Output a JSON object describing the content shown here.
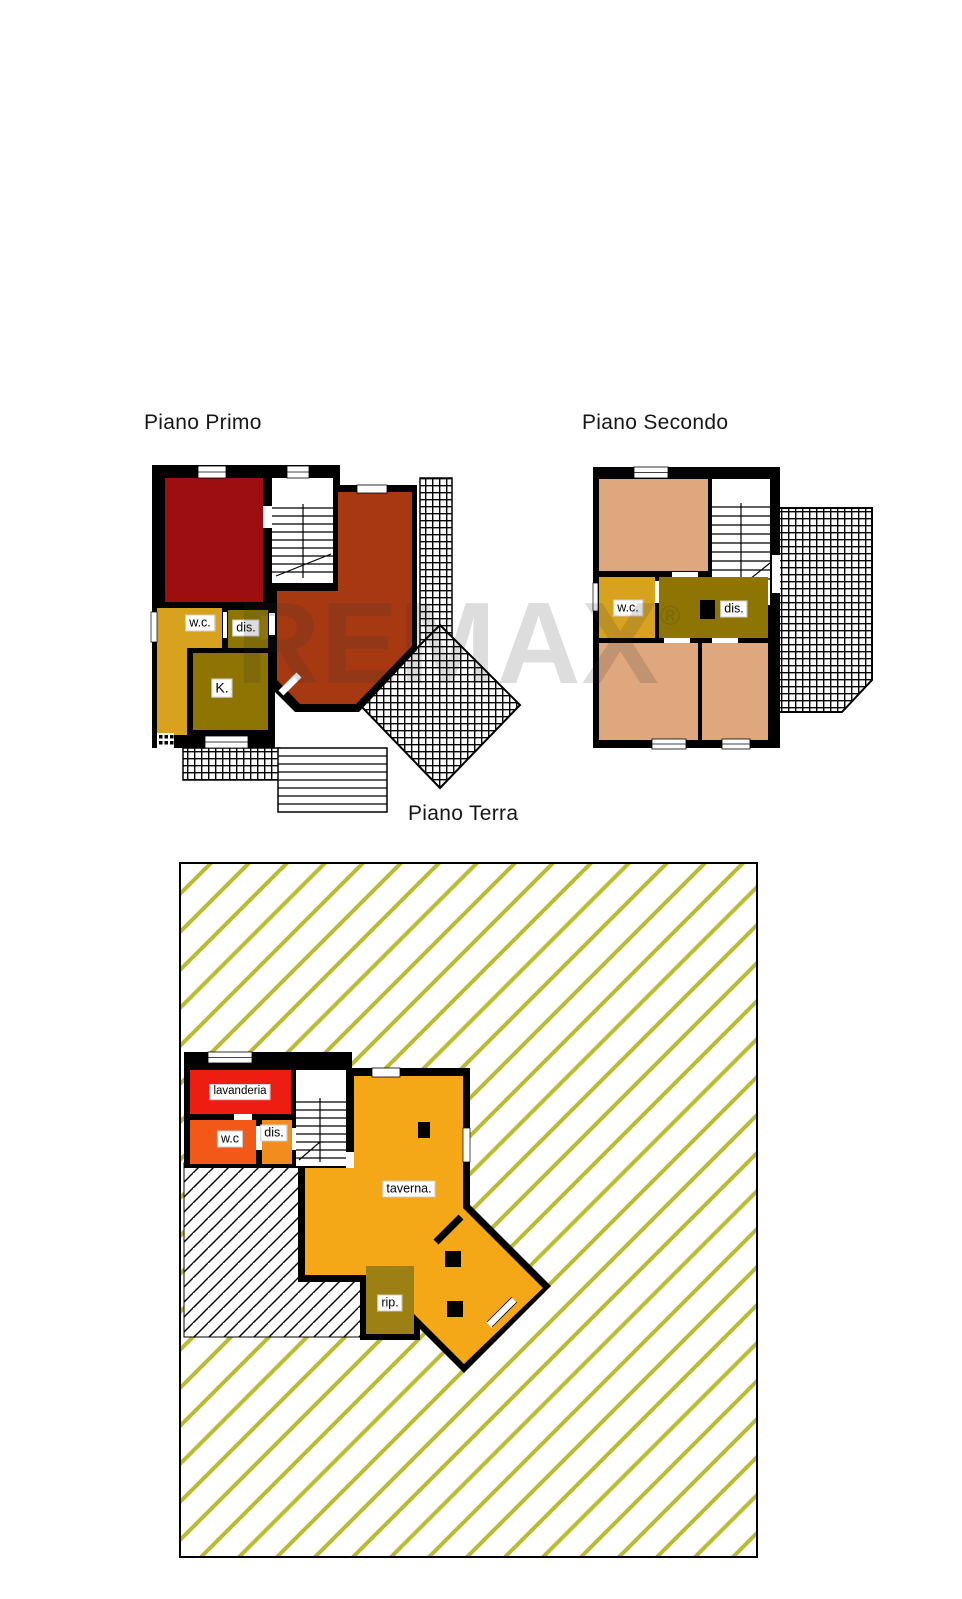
{
  "watermark": {
    "text": "REMAX",
    "registered": "®"
  },
  "colors": {
    "wall": "#000000",
    "dark_red": "#9c0e10",
    "brick": "#a63911",
    "gold": "#d7a31f",
    "olive": "#8e7503",
    "salmon": "#dfa77d",
    "lav_red": "#ee1d11",
    "wc_orange": "#f25818",
    "dis_orange": "#f28c1e",
    "amber": "#f4a717",
    "rip_olive": "#9c8013",
    "plot_stripe": "#b9bc31",
    "white": "#ffffff"
  },
  "floors": {
    "primo": {
      "title": "Piano Primo",
      "rooms": {
        "wc": "w.c.",
        "dis": "dis.",
        "k": "K."
      }
    },
    "secondo": {
      "title": "Piano Secondo",
      "rooms": {
        "wc": "w.c.",
        "dis": "dis."
      }
    },
    "terra": {
      "title": "Piano Terra",
      "rooms": {
        "lavanderia": "lavanderia",
        "wc": "w.c",
        "dis": "dis.",
        "taverna": "taverna.",
        "rip": "rip."
      }
    }
  }
}
